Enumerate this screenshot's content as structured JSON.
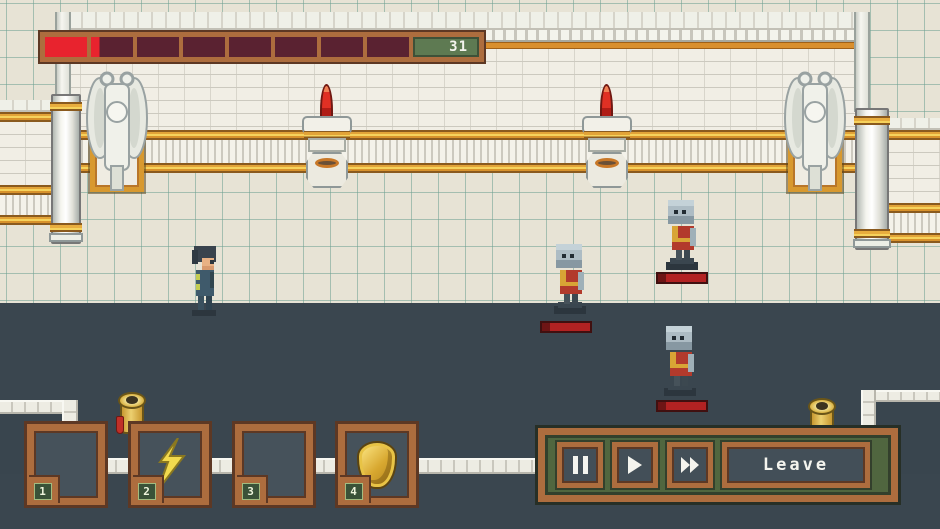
{
  "hud": {
    "health_bar": {
      "counter": "31",
      "segments_total": 8,
      "segments_full": 1,
      "partial_segment_fill_pct": 20
    }
  },
  "action_bar": {
    "slots": [
      {
        "hotkey": "1",
        "content": "empty"
      },
      {
        "hotkey": "2",
        "content": "lightning-bolt"
      },
      {
        "hotkey": "3",
        "content": "empty"
      },
      {
        "hotkey": "4",
        "content": "shield"
      }
    ]
  },
  "playback": {
    "buttons": [
      {
        "name": "pause"
      },
      {
        "name": "play"
      },
      {
        "name": "fast-forward"
      }
    ],
    "leave_label": "Leave"
  },
  "scene": {
    "player_count": 1,
    "enemy_count": 3,
    "enemy_type": "zombie-statue",
    "decor": [
      "angel-statue-left",
      "angel-statue-right",
      "candle-sconce-left",
      "candle-sconce-right",
      "gold-censer-left",
      "gold-censer-right"
    ]
  },
  "colors": {
    "background_slate": "#3a464f",
    "floor": "#e7e3d5",
    "floor_grid": "#6ea091",
    "wall_white": "#f1eee5",
    "trim_gold": "#d8992f",
    "frame_brown": "#ad6d3e",
    "hp_red": "#e8232e",
    "hp_empty": "#5a2231",
    "counter_green": "#5e7a52",
    "panel_green": "#50663f",
    "bolt_yellow": "#f2da4e",
    "shield_gold": "#d8a830",
    "enemy_hp_red": "#b22222"
  }
}
